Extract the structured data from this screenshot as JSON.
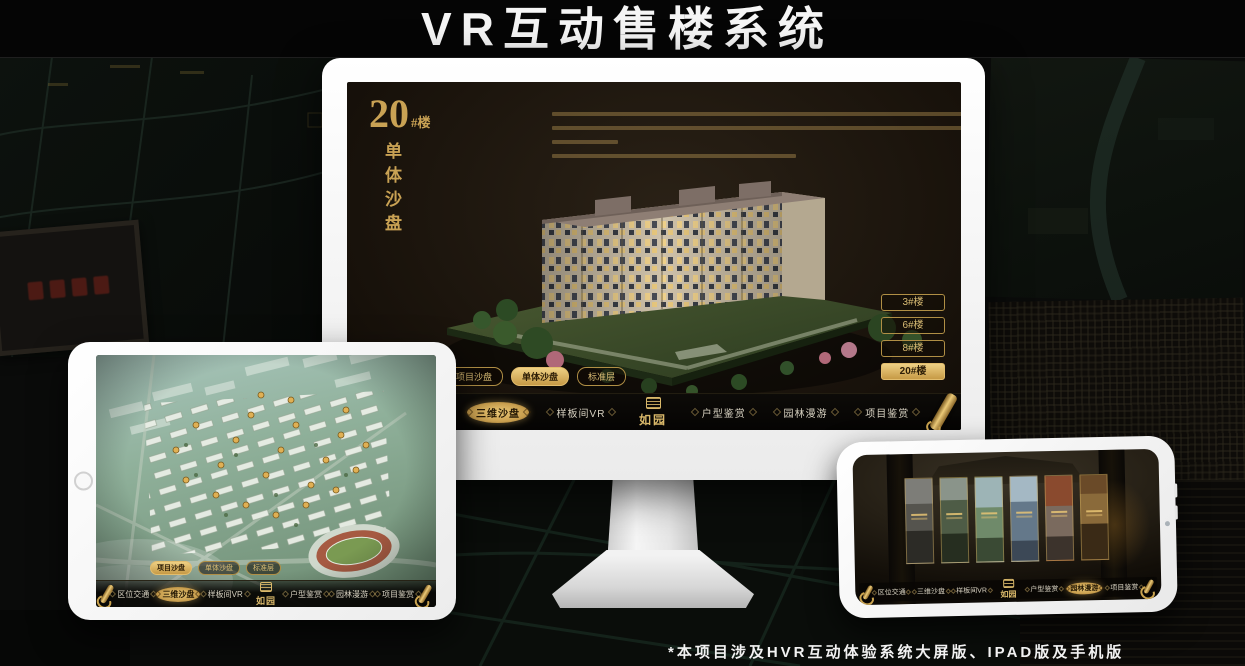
{
  "page": {
    "title": "VR互动售楼系统",
    "footnote": "*本项目涉及HVR互动体验系统大屏版、IPAD版及手机版"
  },
  "brand": {
    "logo": "如园"
  },
  "colors": {
    "gold": "#c9a254",
    "gold_bright": "#e8c878",
    "gold_deep": "#8a6a2f",
    "screen_background": "#171209",
    "title_text": "#f5f5f5"
  },
  "monitor": {
    "headline": {
      "number": "20",
      "suffix": "#楼",
      "subtitle": "单体沙盘"
    },
    "building_buttons": [
      {
        "label": "3#楼",
        "active": false
      },
      {
        "label": "6#楼",
        "active": false
      },
      {
        "label": "8#楼",
        "active": false
      },
      {
        "label": "20#楼",
        "active": true
      }
    ],
    "sub_tabs": [
      {
        "label": "项目沙盘",
        "active": false
      },
      {
        "label": "单体沙盘",
        "active": true
      },
      {
        "label": "标准层",
        "active": false
      }
    ],
    "nav_left": [
      {
        "label": "区位交通",
        "active": false
      },
      {
        "label": "三维沙盘",
        "active": true
      },
      {
        "label": "样板间VR",
        "active": false
      }
    ],
    "nav_right": [
      {
        "label": "户型鉴赏",
        "active": false
      },
      {
        "label": "园林漫游",
        "active": false
      },
      {
        "label": "项目鉴赏",
        "active": false
      }
    ]
  },
  "tablet": {
    "sub_tabs": [
      {
        "label": "项目沙盘",
        "active": true
      },
      {
        "label": "单体沙盘",
        "active": false
      },
      {
        "label": "标准层",
        "active": false
      }
    ],
    "nav_left": [
      {
        "label": "区位交通",
        "active": false
      },
      {
        "label": "三维沙盘",
        "active": true
      },
      {
        "label": "样板间VR",
        "active": false
      }
    ],
    "nav_right": [
      {
        "label": "户型鉴赏",
        "active": false
      },
      {
        "label": "园林漫游",
        "active": false
      },
      {
        "label": "项目鉴赏",
        "active": false
      }
    ]
  },
  "phone": {
    "nav_left": [
      {
        "label": "区位交通",
        "active": false
      },
      {
        "label": "三维沙盘",
        "active": false
      },
      {
        "label": "样板间VR",
        "active": false
      }
    ],
    "nav_right": [
      {
        "label": "户型鉴赏",
        "active": false
      },
      {
        "label": "园林漫游",
        "active": true
      },
      {
        "label": "项目鉴赏",
        "active": false
      }
    ]
  }
}
